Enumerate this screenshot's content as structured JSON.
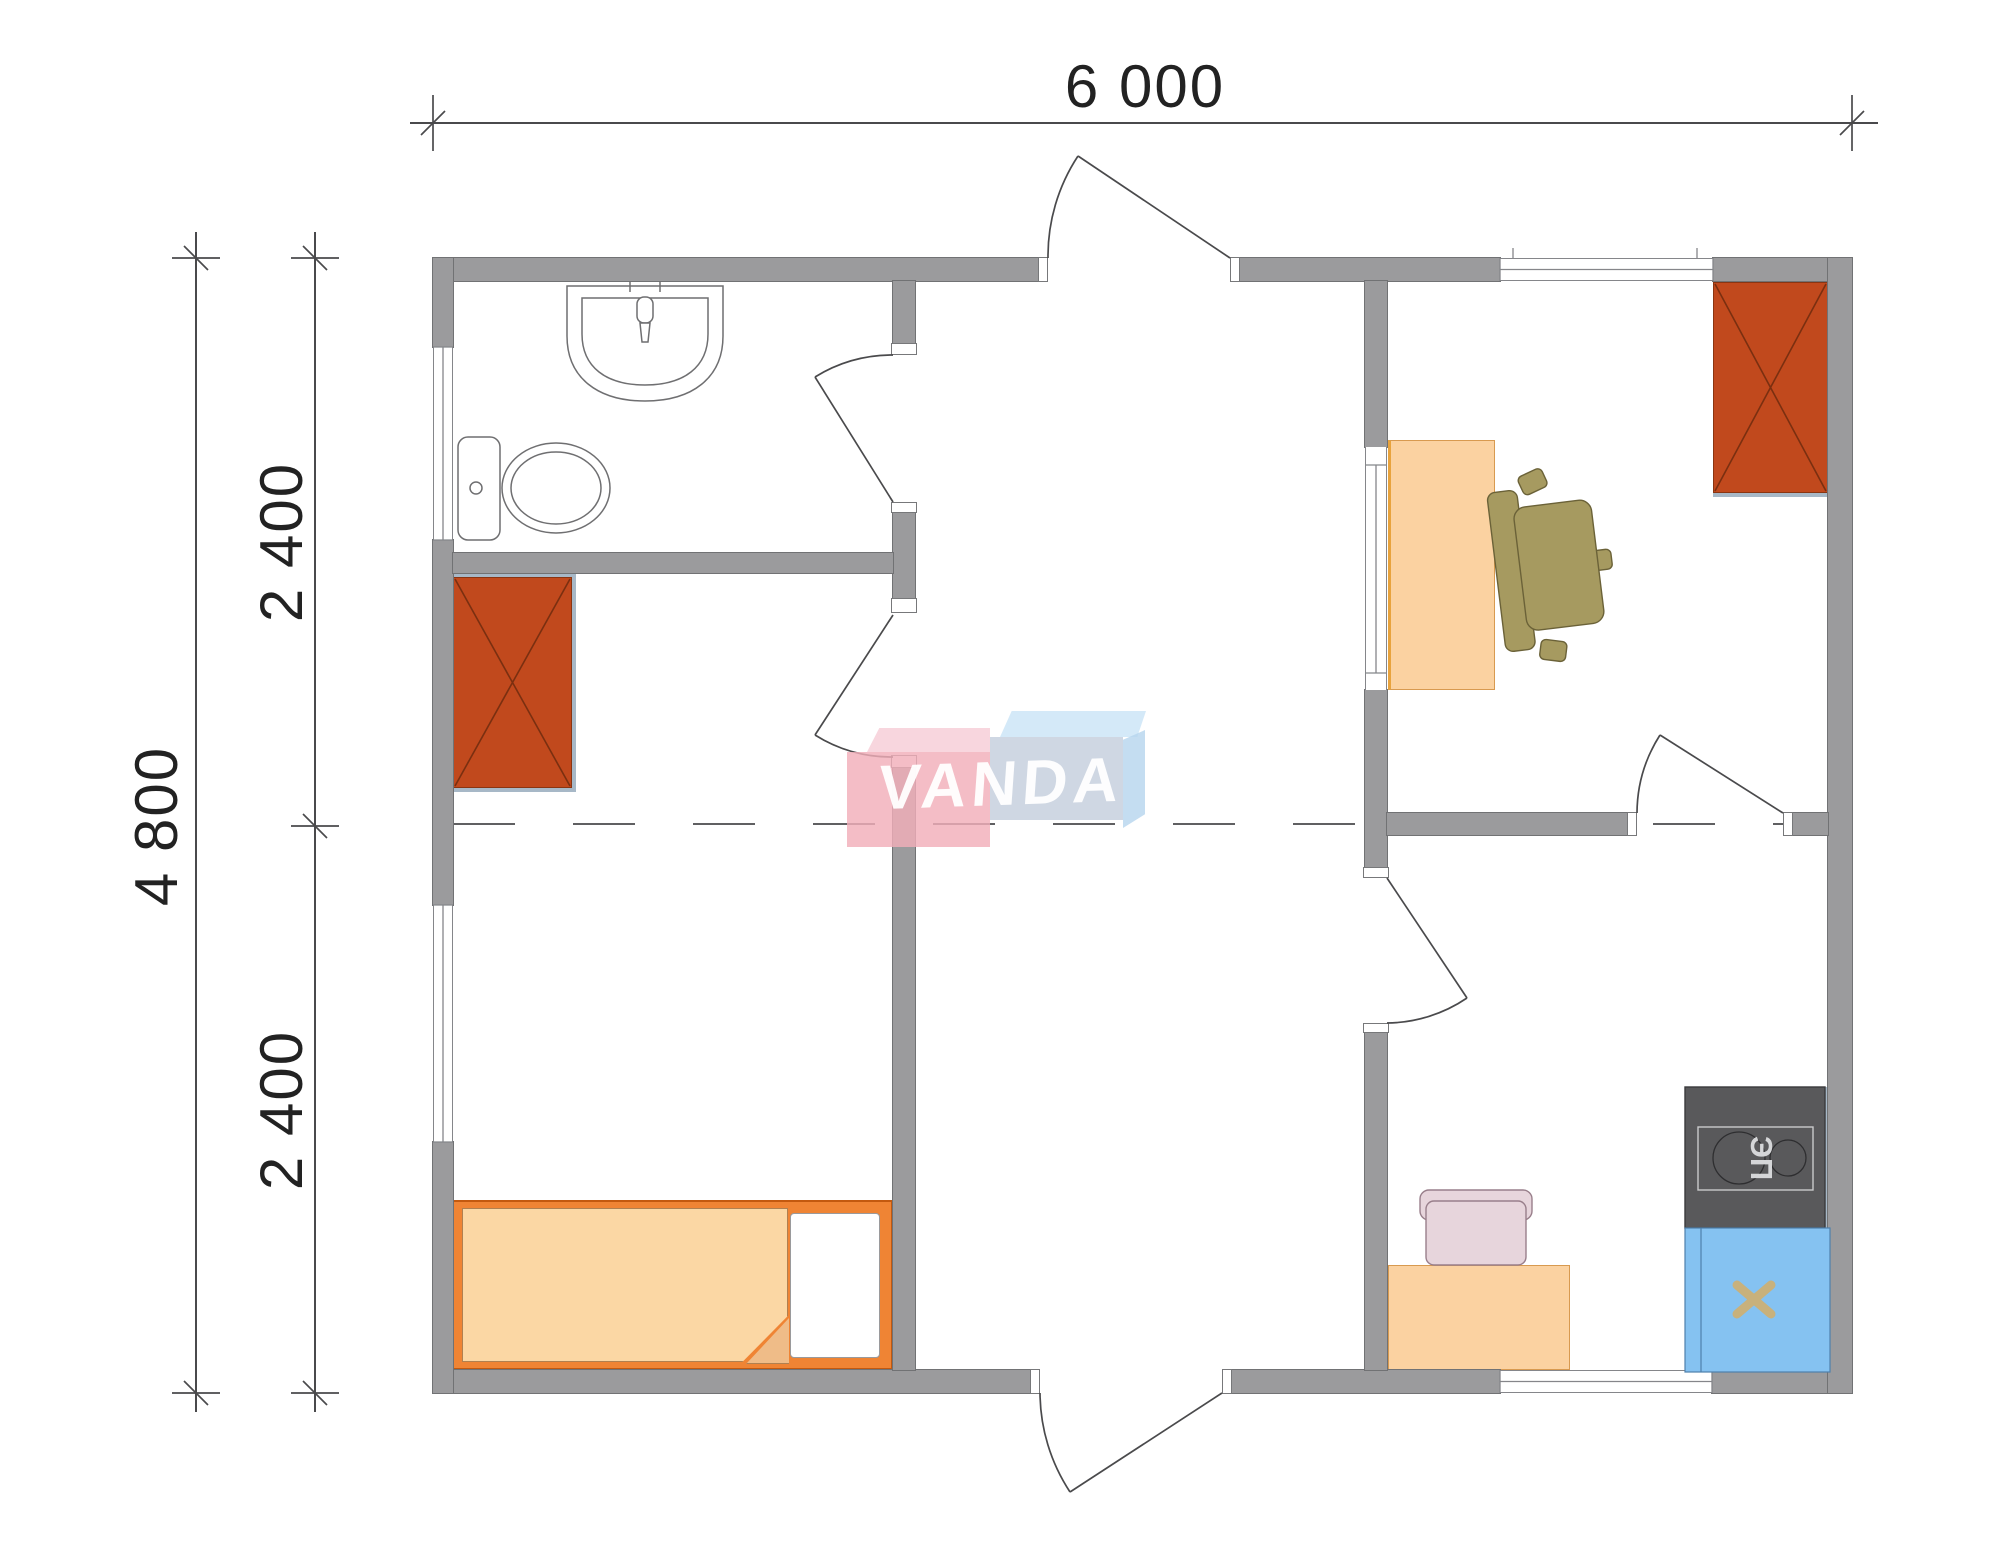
{
  "drawing": {
    "type": "floor-plan",
    "watermark": {
      "text": "VANDA"
    },
    "dimensions": {
      "top_total": {
        "label": "6 000"
      },
      "left_total": {
        "label": "4 800"
      },
      "left_upper": {
        "label": "2 400"
      },
      "left_lower": {
        "label": "2 400"
      }
    },
    "fixtures": {
      "stove_label": "ЭП"
    },
    "colors": {
      "wall": "#9B9B9D",
      "wall_outline": "#717274",
      "wardrobe": "#C1491D",
      "bed_frame": "#EF8434",
      "mattress": "#FBD7A4",
      "desk": "#FBD2A1",
      "office_chair": "#A69A60",
      "kitchen_chair": "#E7D5DC",
      "stove": "#59595B",
      "kitchen_sink": "#85C2F1",
      "sink_cross": "#C8B17C",
      "furniture_shadow": "#A7B8C7",
      "dimension_lines": "#4A4A4C",
      "logo_pink": "#F2AEBA",
      "logo_blue": "#C4CEDD",
      "logo_lightblue": "#CCE5F7"
    }
  }
}
